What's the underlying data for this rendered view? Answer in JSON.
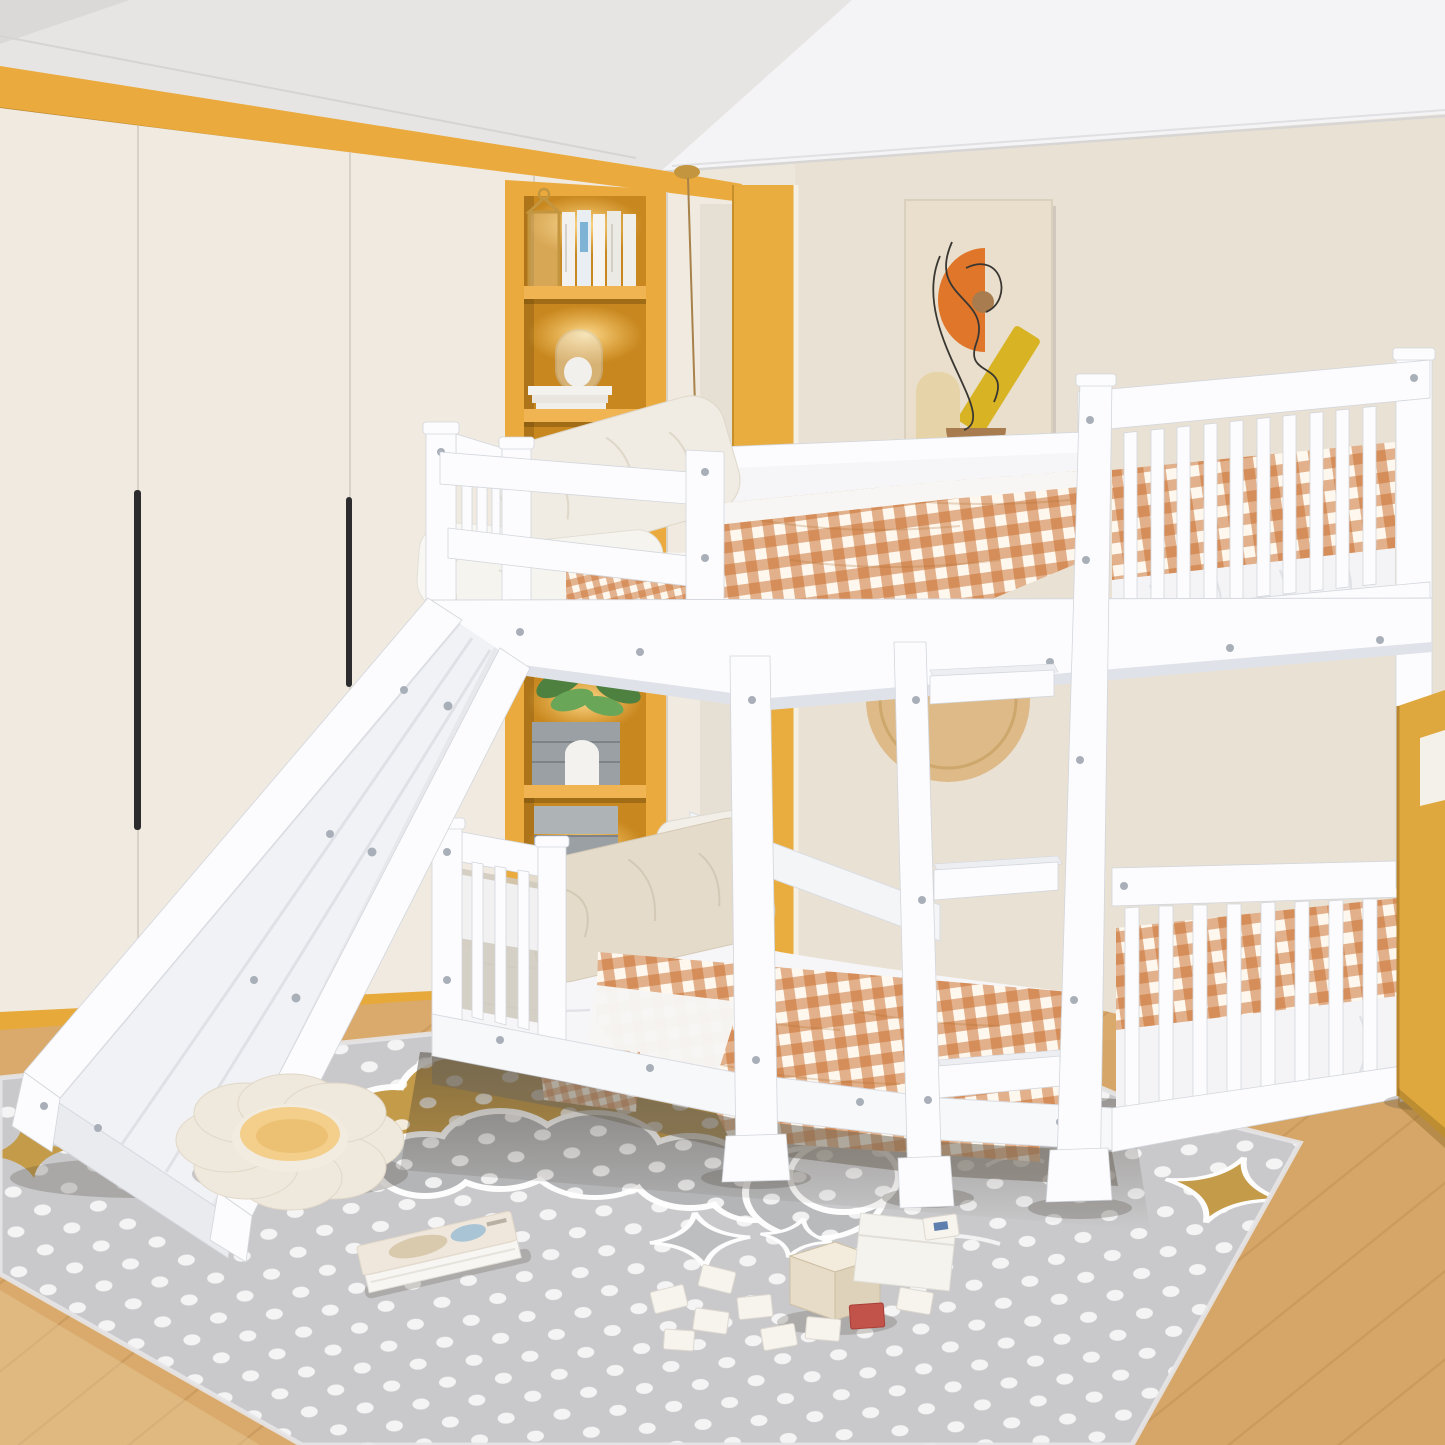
{
  "meta": {
    "description": "Kids bedroom product photo: white twin-over-twin low bunk bed with guard rails, end ladder and left slide, orange gingham bedding, cream wardrobe wall, yellow accent niches with shelves, abstract wall art, grey polka-dot rug with gold clouds, moon and stars on light oak floor"
  },
  "palette": {
    "wall_left": "#ece6db",
    "wall_back": "#e9e1d4",
    "ceiling_left": "#e7e5e3",
    "ceiling_right": "#f4f4f6",
    "ceiling_wedge": "#dbd9d7",
    "accent_yellow": "#eaaa3d",
    "accent_panel": "#e9ac3e",
    "baseboard_yellow": "#e7a93a",
    "wardrobe": "#f0eae1",
    "handle_black": "#2c2c2e",
    "shelf_interior": "#c8871f",
    "shelf_band": "#f0b452",
    "wood_floor": "#d9aa6c",
    "wood_seam": "#c29158",
    "rug_base": "#c9c9cb",
    "rug_dot": "#ffffff",
    "rug_cloud_gold": "#c49b49",
    "rug_cloud_grey": "#b4b5b7",
    "rug_moon": "#b9babc",
    "bed_white": "#fcfcfe",
    "gingham": "#c96f2f",
    "mattress": "#f6f6f8",
    "pillow_beige": "#e4dbcb",
    "pillow_white": "#f0ece3",
    "stripe_dark": "#2e2d2b",
    "cabinet_yellow": "#dfa83f",
    "art_bg": "#e9dfcc",
    "art_orange": "#e0762a",
    "art_yellow": "#d8b324",
    "art_brown": "#a97c4f",
    "art_sand": "#e6d4a8",
    "plush_white": "#efe8dc",
    "plush_yellow": "#f3cf8b",
    "frame_white": "#f6f4f0",
    "plant_green": "#4e8040",
    "crate_grey": "#9aa0a4",
    "metal_gold": "#c3953e"
  }
}
